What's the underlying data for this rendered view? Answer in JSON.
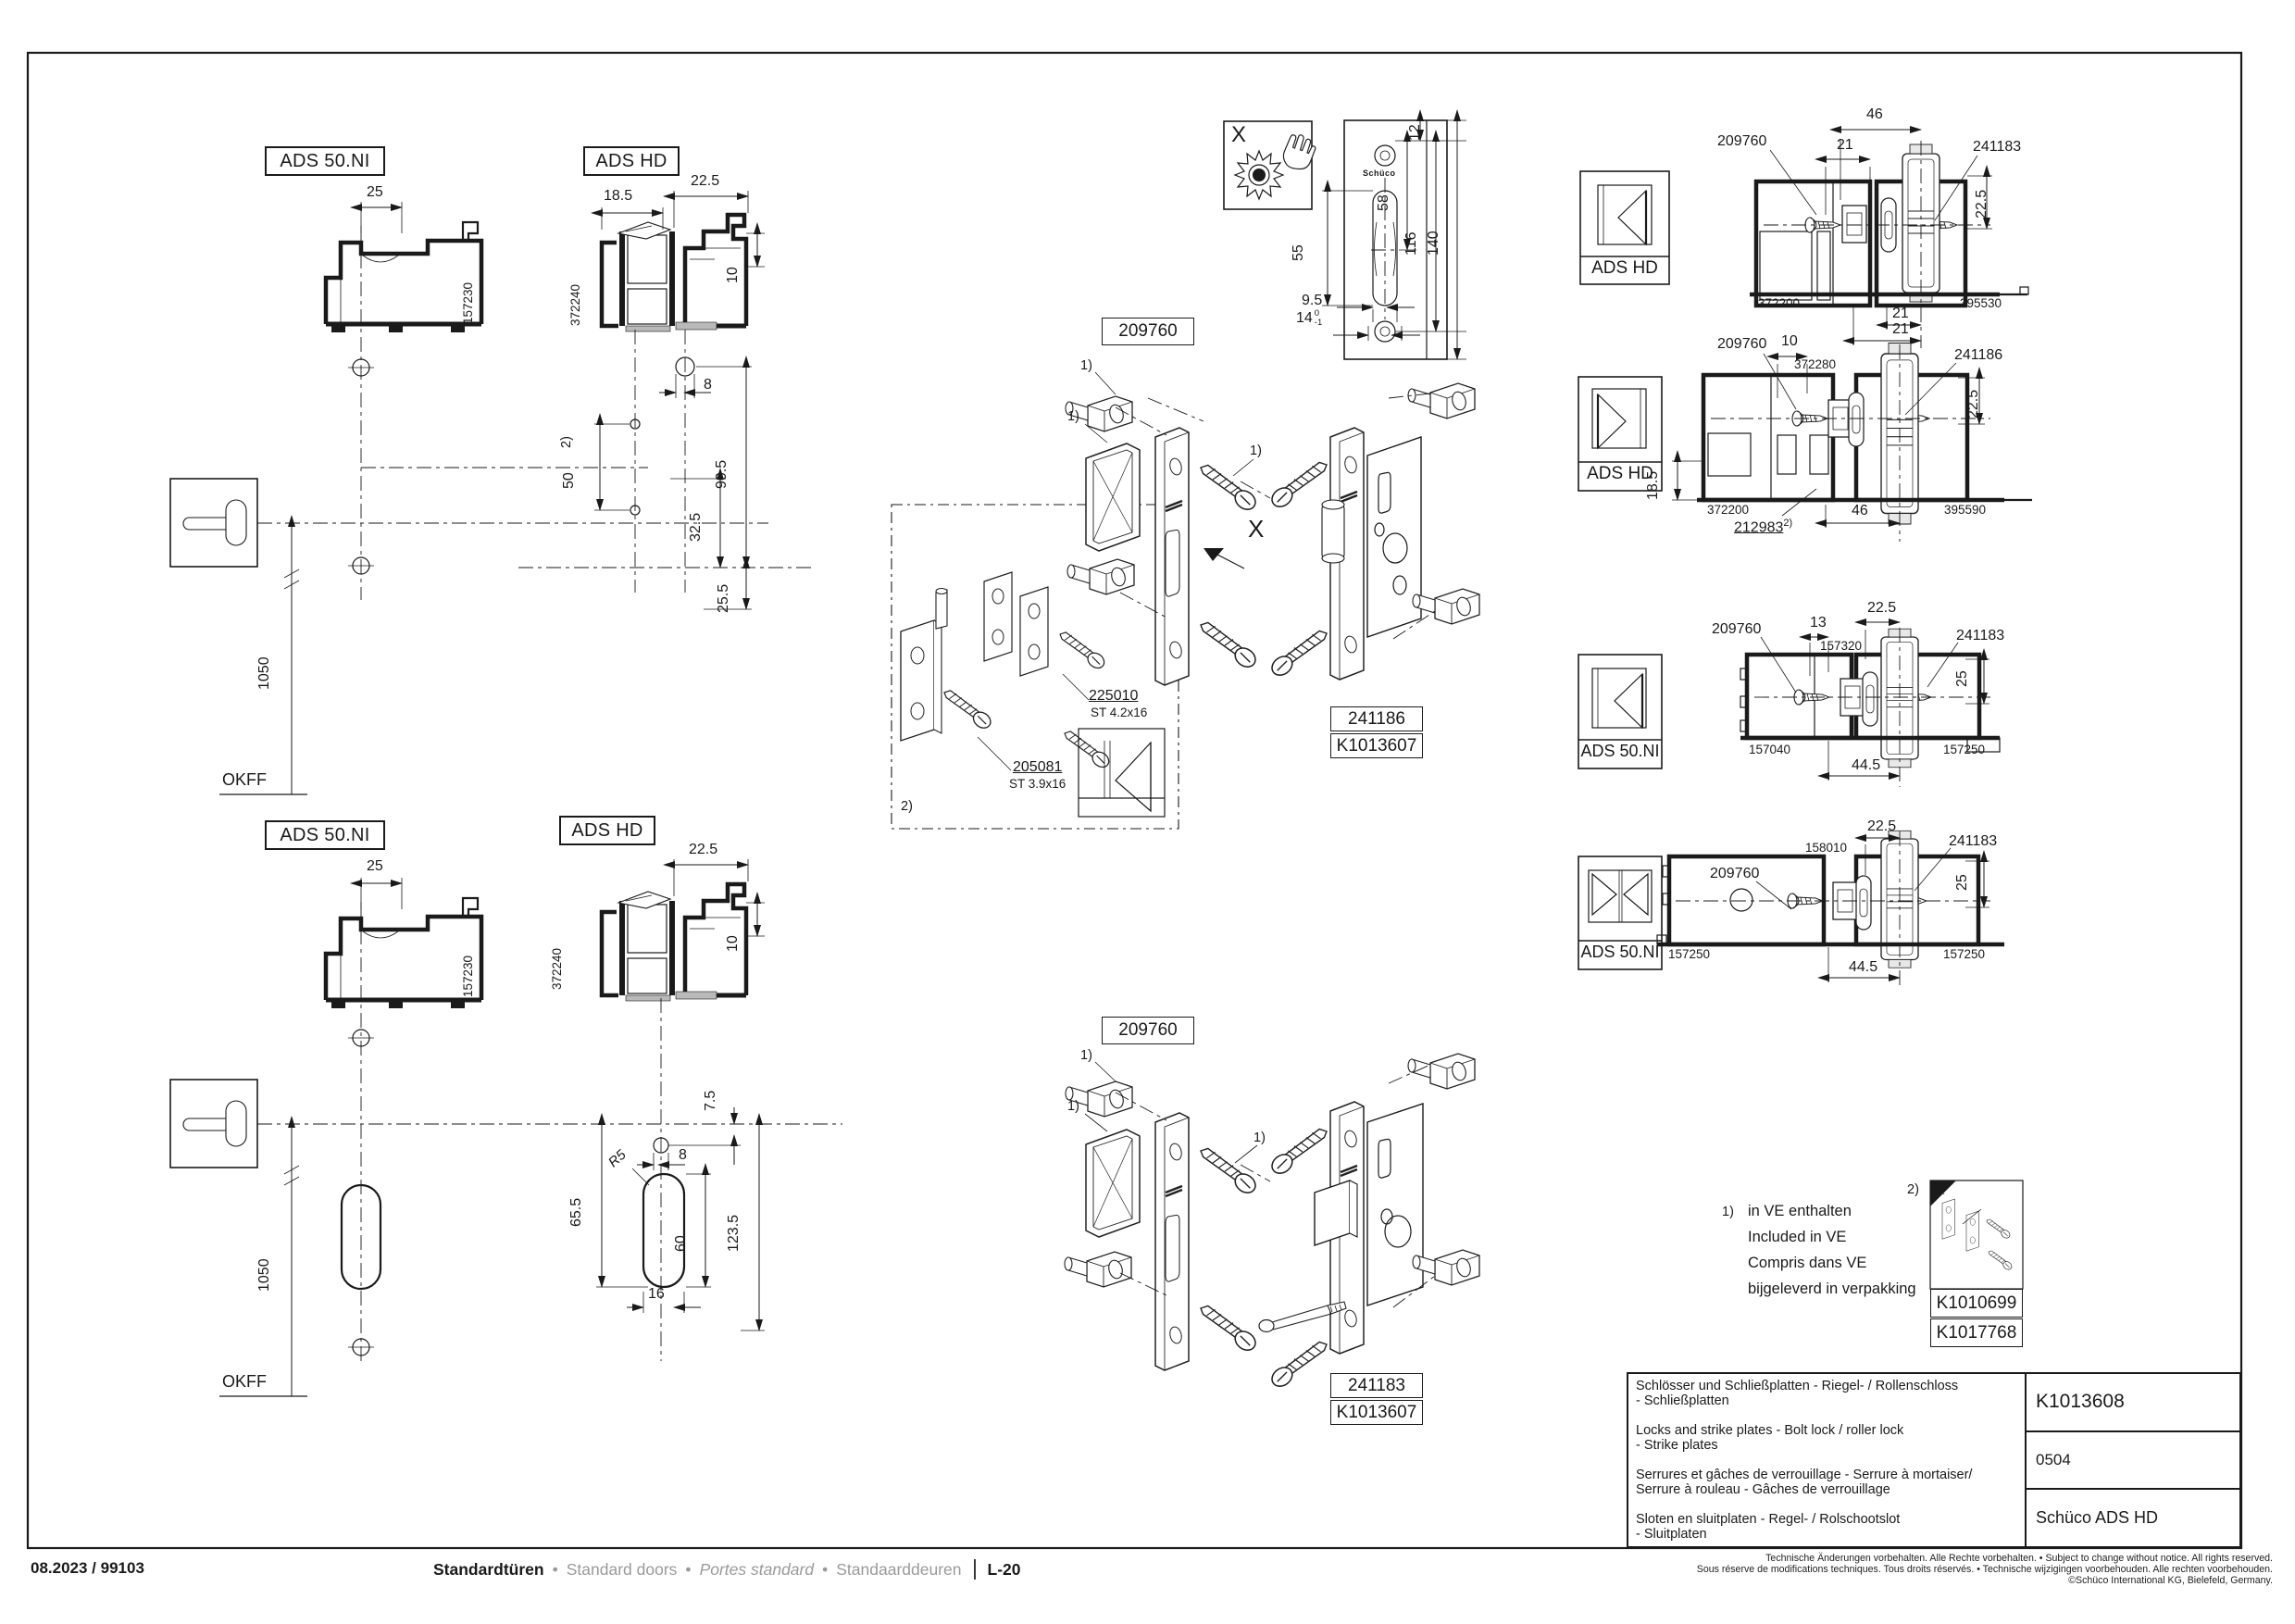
{
  "upper_detail": {
    "ads50_label": "ADS 50.NI",
    "ads50_profile": "157230",
    "d25": "25",
    "adshd_label": "ADS HD",
    "adshd_profile": "372240",
    "d18_5": "18.5",
    "d22_5": "22.5",
    "d10": "10",
    "d8": "8",
    "d50": "50",
    "ref2": "2)",
    "d90_5": "90.5",
    "d32_5": "32.5",
    "d25_5": "25.5",
    "d1050": "1050",
    "okff": "OKFF"
  },
  "lower_detail": {
    "ads50_label": "ADS 50.NI",
    "ads50_profile": "157230",
    "d25": "25",
    "adshd_label": "ADS HD",
    "adshd_profile": "372240",
    "d22_5": "22.5",
    "d10": "10",
    "d7_5": "7.5",
    "d8": "8",
    "r5": "R5",
    "d65_5": "65.5",
    "d60": "60",
    "d16": "16",
    "d123_5": "123.5",
    "d1050": "1050",
    "okff": "OKFF"
  },
  "detail_x": {
    "label": "X",
    "brand": "Schüco",
    "d12": "12",
    "d58": "58",
    "d55": "55",
    "d116": "116",
    "d140": "140",
    "d9_5": "9.5",
    "d14": "14",
    "tol_top": "0",
    "tol_bot": "-1"
  },
  "exploded_top": {
    "part": "209760",
    "ref1": "1)",
    "x_label": "X",
    "screw1_code": "225010",
    "screw1_size": "ST 4.2x16",
    "screw2_code": "205081",
    "screw2_size": "ST 3.9x16",
    "ref2": "2)",
    "lock_code": "241186",
    "kit_code": "K1013607"
  },
  "exploded_bottom": {
    "part": "209760",
    "ref1": "1)",
    "lock_code": "241183",
    "kit_code": "K1013607"
  },
  "sections": [
    {
      "system": "ADS HD",
      "part_leader": "209760",
      "lock_leader": "241183",
      "dim46": "46",
      "dim21": "21",
      "dim21b": "21",
      "dim21c": "21",
      "dim22_5": "22.5",
      "profile_left": "372200",
      "profile_right": "395530"
    },
    {
      "system": "ADS HD",
      "part_leader": "209760",
      "lock_leader": "241186",
      "dim10": "10",
      "profile_mid": "372280",
      "dim22_5": "22.5",
      "dim18_5": "18.5",
      "profile_left": "372200",
      "profile_right": "395590",
      "gasket": "212983",
      "gasket_ref": "2)",
      "dim46": "46"
    },
    {
      "system": "ADS 50.NI",
      "part_leader": "209760",
      "lock_leader": "241183",
      "dim13": "13",
      "profile_mid": "157320",
      "dim22_5": "22.5",
      "dim25": "25",
      "profile_left": "157040",
      "profile_right": "157250",
      "dim44_5": "44.5"
    },
    {
      "system": "ADS 50.NI",
      "part_leader": "209760",
      "lock_leader": "241183",
      "profile_mid": "158010",
      "dim22_5": "22.5",
      "dim25": "25",
      "profile_left": "157250",
      "profile_right": "157250",
      "dim44_5": "44.5"
    }
  ],
  "legend": {
    "ref1": "1)",
    "line_de": "in VE enthalten",
    "line_en": "Included in VE",
    "line_fr": "Compris dans VE",
    "line_nl": "bijgeleverd in verpakking",
    "ref2": "2)",
    "kit1": "K1010699",
    "kit2": "K1017768"
  },
  "title_block": {
    "de": "Schlösser und Schließplatten - Riegel- / Rollenschloss\n- Schließplatten",
    "en": "Locks and strike plates - Bolt lock / roller lock\n - Strike plates",
    "fr": "Serrures et gâches de verrouillage - Serrure à mortaiser/\nSerrure à rouleau - Gâches de verrouillage",
    "nl": "Sloten en sluitplaten - Regel- / Rolschootslot\n - Sluitplaten",
    "doc_no": "K1013608",
    "version": "0504",
    "system": "Schüco ADS HD"
  },
  "footer": {
    "date_code": "08.2023 / 99103",
    "nav_de": "Standardtüren",
    "nav_en": "Standard doors",
    "nav_fr": "Portes standard",
    "nav_nl": "Standaarddeuren",
    "sep": "•",
    "page_code": "L-20",
    "legal1": "Technische Änderungen vorbehalten. Alle Rechte vorbehalten. • Subject to change without notice. All rights reserved.",
    "legal2": "Sous réserve de modifications techniques. Tous droits réservés. • Technische wijzigingen voorbehouden. Alle rechten voorbehouden.",
    "legal3": "©Schüco International KG, Bielefeld, Germany."
  }
}
